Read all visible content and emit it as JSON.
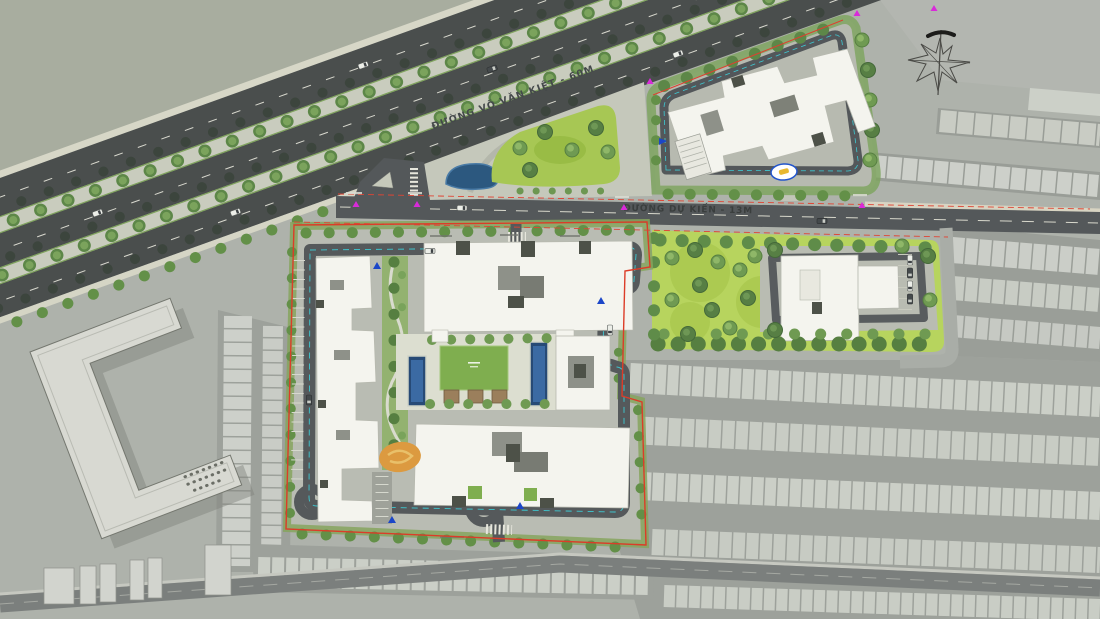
{
  "labels": {
    "road_main": "ĐƯỜNG VÕ VĂN KIỆT - 60M",
    "road_planned": "ĐƯỜNG DỰ KIẾN - 13M"
  },
  "icons": {
    "compass": "hand-drawn-north-arrow",
    "survey_marker": "magenta-triangle-point",
    "entrance_marker": "blue-triangle",
    "tree": "green-canopy-circle",
    "car": "vehicle-top-view"
  },
  "colors": {
    "background": "#aeb2ab",
    "asphalt": "#4a4e4d",
    "median": "#c9ccbe",
    "tree_green": "#6f9a52",
    "lawn_bright": "#a7c754",
    "park_lawn": "#b7d45e",
    "building_white": "#f4f4ee",
    "existing_building": "#cbcfc7",
    "internal_road": "#55595b",
    "boundary_red": "#dc3c28",
    "guide_cyan": "#3ec9d2",
    "marker_magenta": "#d92ad9",
    "pool_blue": "#274a76",
    "courtyard_paving": "#dcded0",
    "playground_orange": "#dc9a40"
  }
}
